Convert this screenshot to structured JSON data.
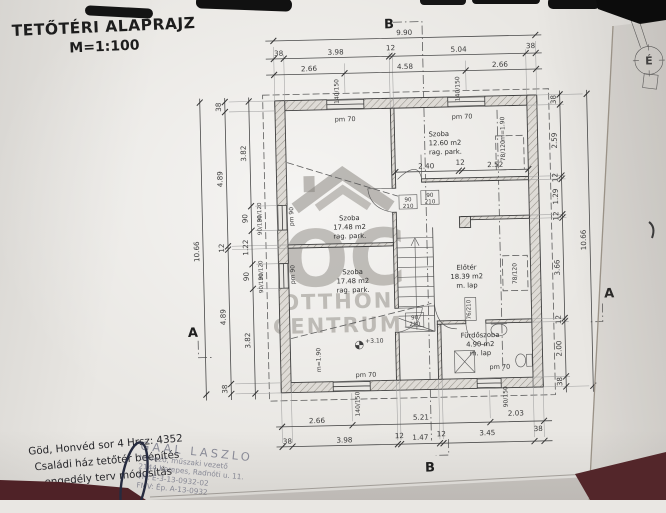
{
  "title": {
    "line1": "TETŐTÉRI ALAPRAJZ",
    "line2": "M=1:100"
  },
  "north": {
    "label": "É"
  },
  "sections": {
    "a": "A",
    "b": "B"
  },
  "watermark": {
    "initials": "OC",
    "line1": "OTTHON",
    "line2": "CENTRUM"
  },
  "rooms": {
    "szoba1": {
      "name": "Szoba",
      "area": "17.48 m2",
      "finish": "rag. park."
    },
    "szoba2": {
      "name": "Szoba",
      "area": "17.48 m2",
      "finish": "rag. park."
    },
    "szoba3": {
      "name": "Szoba",
      "area": "12.60 m2",
      "finish": "rag. park."
    },
    "eloter": {
      "name": "Előtér",
      "area": "18.39 m2",
      "finish": "m. lap"
    },
    "furdo": {
      "name": "Fürdőszoba",
      "area": "4.90 m2",
      "finish": "m. lap"
    }
  },
  "levels": {
    "floor": "+3.10"
  },
  "dims": {
    "top_total": "9.90",
    "top_row2": [
      "38",
      "3.98",
      "12",
      "5.04",
      "38"
    ],
    "top_row3": [
      "2.66",
      "4.58",
      "2.66"
    ],
    "left_total": "10.66",
    "left_col2": [
      "38",
      "4.89",
      "12",
      "4.89",
      "38"
    ],
    "left_col3": [
      "3.82",
      "90",
      "1.22",
      "90",
      "3.82"
    ],
    "right_total": "10.66",
    "right_col": [
      "38",
      "2.59",
      "12",
      "1.29",
      "12",
      "3.66",
      "12",
      "2.00",
      "38"
    ],
    "bottom_row1": [
      "2.66",
      "5.21",
      "2.03"
    ],
    "bottom_row2": [
      "38",
      "3.98",
      "12",
      "1.47",
      "12",
      "3.45",
      "38"
    ],
    "szoba3_internal": [
      "2.40",
      "12",
      "2.52"
    ]
  },
  "tags": {
    "window_140": "140/150",
    "window_bath": "90/150",
    "window_side": "90/120",
    "roof_window": "78/120",
    "sill_height": "m=1.90",
    "door_w": "90",
    "door_h": "210",
    "door_bath": "76/210",
    "parapet_70": "pm 70",
    "parapet_90": "pm 90"
  },
  "footer": {
    "line1": "Göd, Honvéd sor 4 Hrsz: 4352",
    "line2": "Családi ház tetőtér beépítés",
    "line3": "engedély terv módosítás"
  },
  "stamp": {
    "line1": "GAAL LASZLO",
    "line2": "tervező, műszaki vezető",
    "line3": "2144 Kerepes, Radnóti u. 11.",
    "line4": "TN: E-3-13-0932-02",
    "line5": "FMV: Ép. A-13-0932"
  }
}
